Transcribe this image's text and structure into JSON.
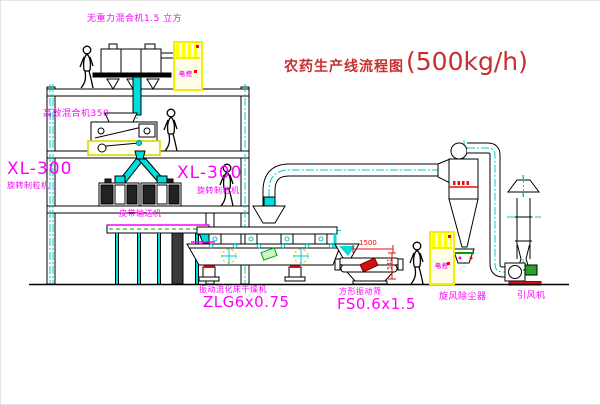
{
  "title": {
    "text": "农药生产线流程图",
    "capacity": "(500kg/h)"
  },
  "equipment": {
    "gravity_mixer": {
      "label": "无重力混合机1.5 立方"
    },
    "mixer350": {
      "label": "高效混合机350"
    },
    "granulator_left": {
      "model": "XL-300",
      "name": "旋转制粒机"
    },
    "granulator_right": {
      "model": "XL-300",
      "name": "旋转制粒机"
    },
    "belt_conveyor": {
      "label": "皮带输送机"
    },
    "dryer": {
      "name": "振动流化床干燥机",
      "model": "ZLG6x0.75"
    },
    "screen": {
      "name": "方形振动筛",
      "model": "FS0.6x1.5"
    },
    "cyclone": {
      "label": "旋风除尘器"
    },
    "fan": {
      "label": "引风机"
    },
    "cabinet_top": {
      "label": "电控"
    },
    "cabinet_ground": {
      "label": "电控"
    }
  },
  "dimensions": {
    "screen_width": "1500",
    "screen_height": "541"
  },
  "colors": {
    "label_magenta": "#ff00ff",
    "title_red": "#c53030",
    "line_black": "#000000",
    "centerline_cyan": "#00cccc",
    "cabinet_yellow": "#f0f000",
    "accent_red": "#ff0000",
    "accent_green": "#00a000",
    "accent_yellow": "#d8d800"
  }
}
